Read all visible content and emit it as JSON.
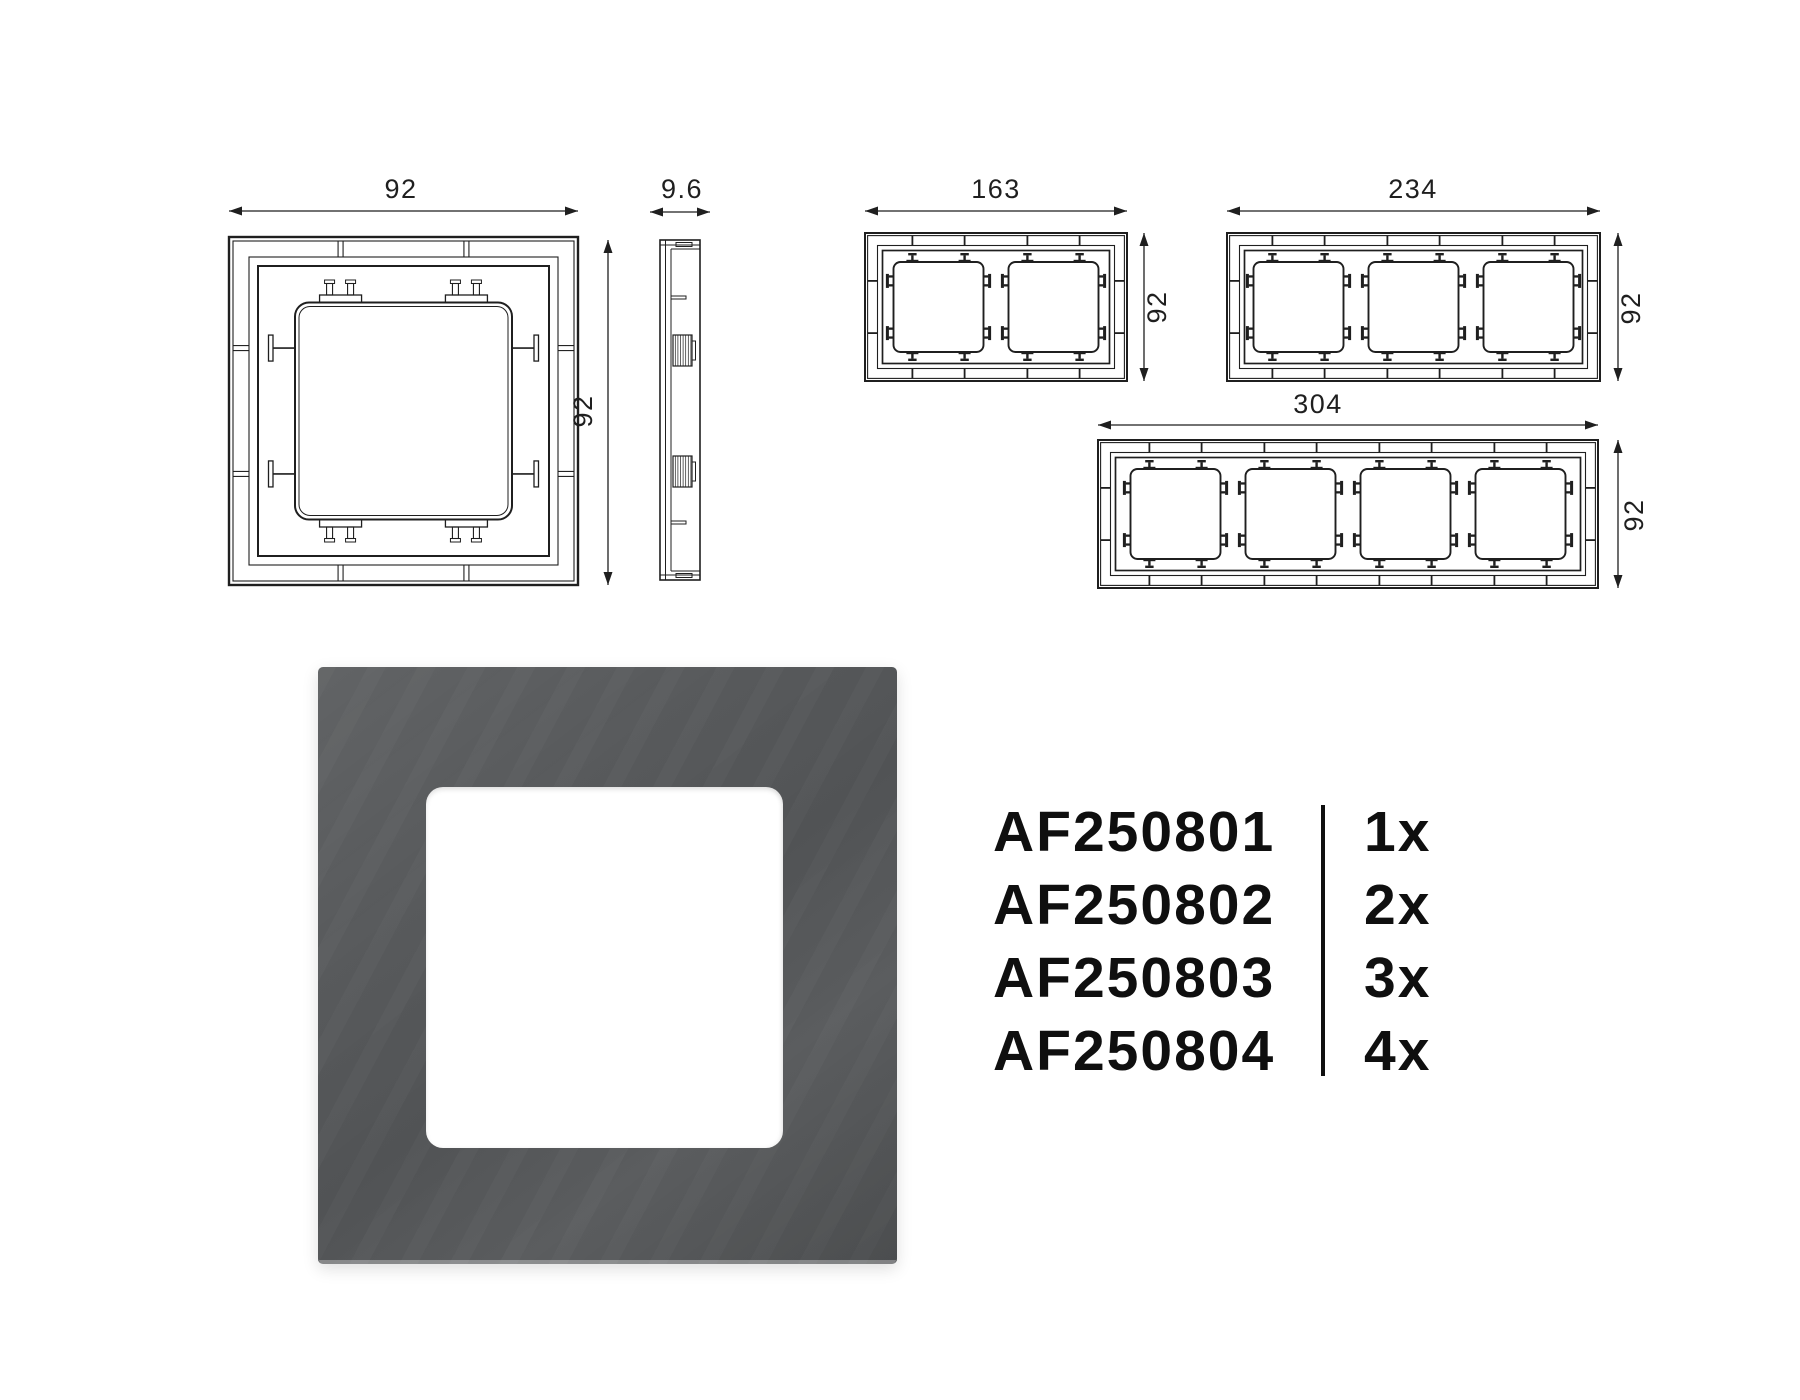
{
  "dimensions": {
    "frame_1gang": {
      "width": "92",
      "height": "92"
    },
    "side_profile": {
      "depth": "9.6"
    },
    "frame_2gang": {
      "width": "163",
      "height": "92"
    },
    "frame_3gang": {
      "width": "234",
      "height": "92"
    },
    "frame_4gang": {
      "width": "304",
      "height": "92"
    }
  },
  "part_list": {
    "items": [
      {
        "sku": "AF250801",
        "quantity": "1x"
      },
      {
        "sku": "AF250802",
        "quantity": "2x"
      },
      {
        "sku": "AF250803",
        "quantity": "3x"
      },
      {
        "sku": "AF250804",
        "quantity": "4x"
      }
    ]
  },
  "photo": {
    "frame_color": "#56585a",
    "opening_color": "#ffffff"
  },
  "drawing": {
    "line_color": "#1f1f1f"
  }
}
